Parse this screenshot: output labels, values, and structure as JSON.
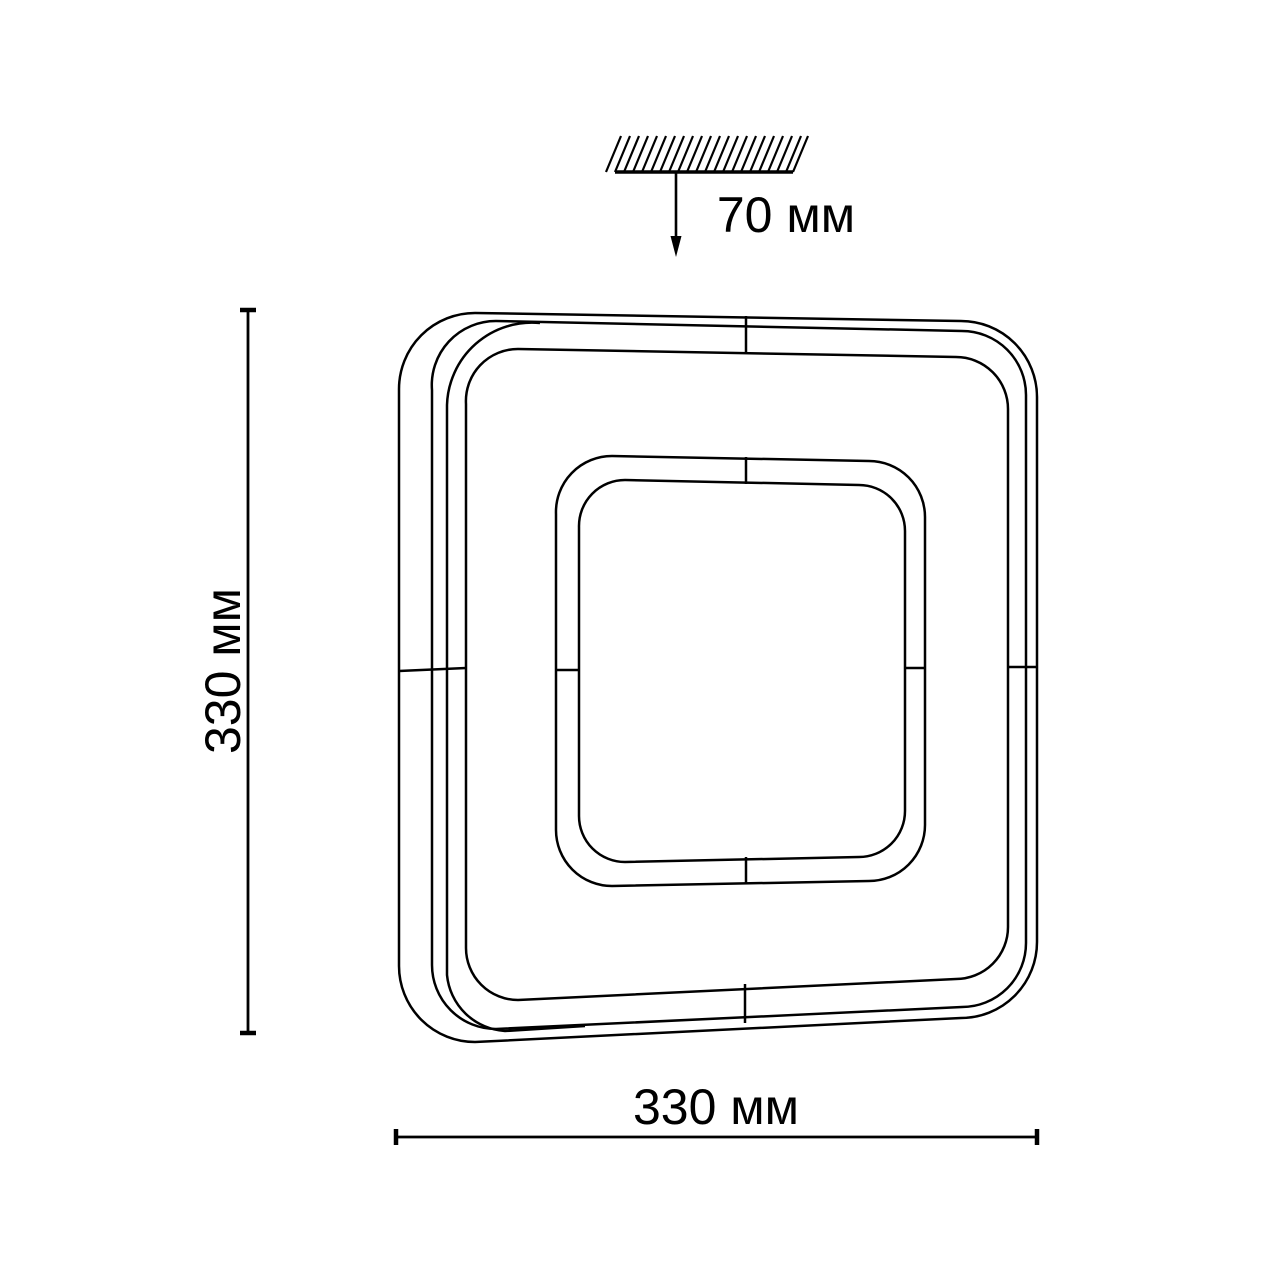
{
  "dimensions": {
    "mount_height": "70 мм",
    "fixture_height": "330 мм",
    "fixture_width": "330 мм"
  },
  "colors": {
    "line": "#000000",
    "background": "#ffffff"
  }
}
